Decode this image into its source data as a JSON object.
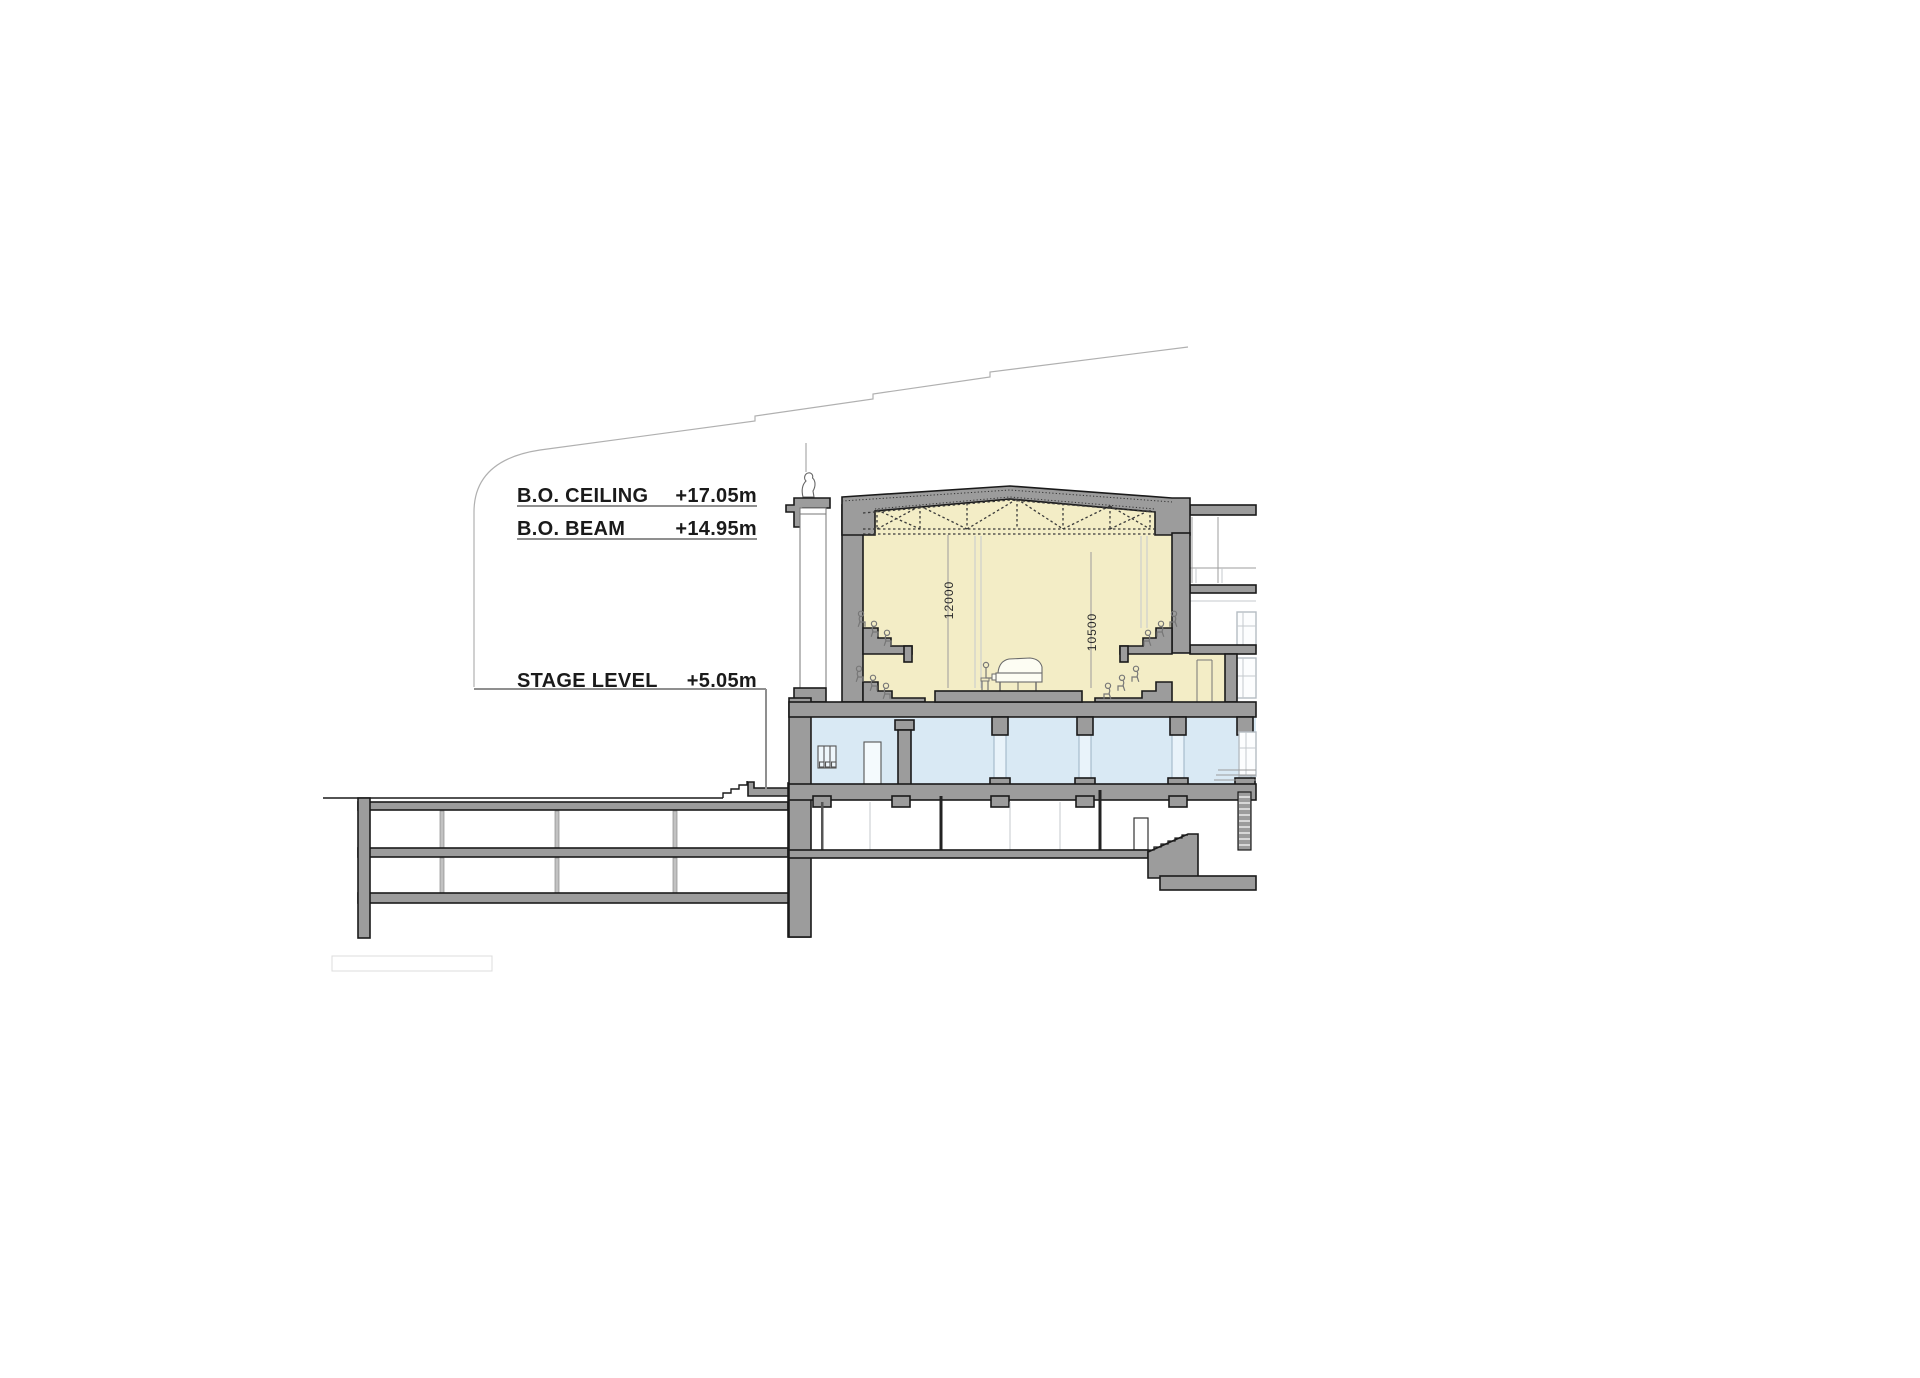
{
  "page": {
    "type": "architectural-section-drawing",
    "background": "#ffffff"
  },
  "annotations": {
    "rows": [
      {
        "id": "bo-ceiling",
        "label": "B.O. CEILING",
        "value": "+17.05m"
      },
      {
        "id": "bo-beam",
        "label": "B.O. BEAM",
        "value": "+14.95m"
      },
      {
        "id": "stage-level",
        "label": "STAGE LEVEL",
        "value": "+5.05m"
      }
    ]
  },
  "dimensions": {
    "hall_height": "12000",
    "stage_opening_height": "10500"
  },
  "colors": {
    "hall_fill": "#f3edc6",
    "foyer_fill": "#d9e9f4",
    "cut_poche": "#9c9c9c",
    "outline": "#1a1a1a",
    "faint_line": "#c4c9cd",
    "leader_line": "#b0b0b0",
    "underline": "#8f8f8f",
    "text": "#1a1a1a"
  }
}
